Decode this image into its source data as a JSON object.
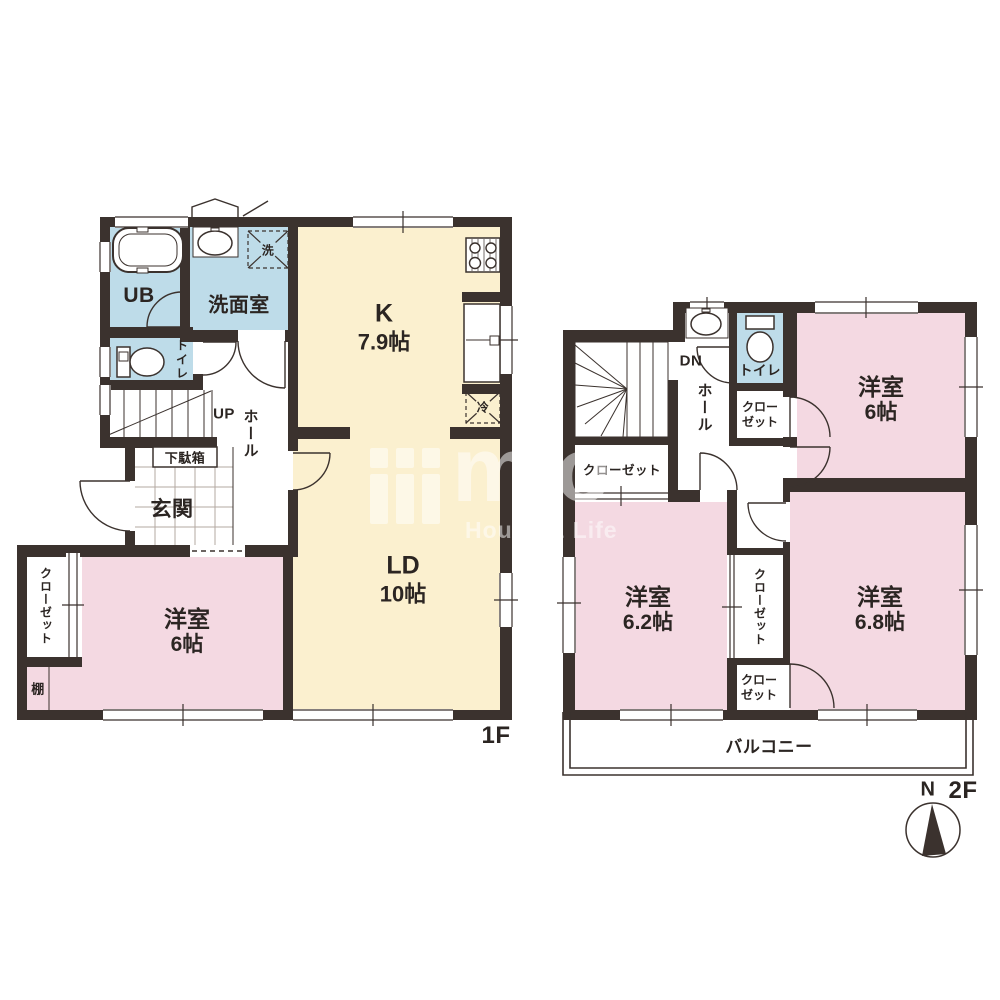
{
  "f1": {
    "floor": "1F",
    "ub": "UB",
    "senmen": "洗面室",
    "wash": "洗",
    "wc": "トイレ",
    "up": "UP",
    "hall": "ホール",
    "getabako": "下駄箱",
    "genkan": "玄関",
    "k_name": "K",
    "k_size": "7.9帖",
    "fridge": "冷",
    "ld_name": "LD",
    "ld_size": "10帖",
    "yo_name": "洋室",
    "yo_size": "6帖",
    "closet": "クローゼット",
    "tana": "棚"
  },
  "f2": {
    "floor": "2F",
    "dn": "DN",
    "wc": "トイレ",
    "hall": "ホール",
    "closet_ne_1": "クロー",
    "closet_ne_2": "ゼット",
    "closet_w": "クローゼット",
    "closet_mid": "クローゼット",
    "closet_s_1": "クロー",
    "closet_s_2": "ゼット",
    "r6_name": "洋室",
    "r6_size": "6帖",
    "r62_name": "洋室",
    "r62_size": "6.2帖",
    "r68_name": "洋室",
    "r68_size": "6.8帖",
    "balcony": "バルコニー",
    "north": "N"
  },
  "watermark": {
    "logo": "mio",
    "tagline": "House & Life"
  },
  "colors": {
    "wall": "#3b322e",
    "room_pink": "#f4d9e2",
    "room_yellow": "#fbf0cf",
    "room_blue": "#bedce9",
    "text": "#2b2522"
  }
}
